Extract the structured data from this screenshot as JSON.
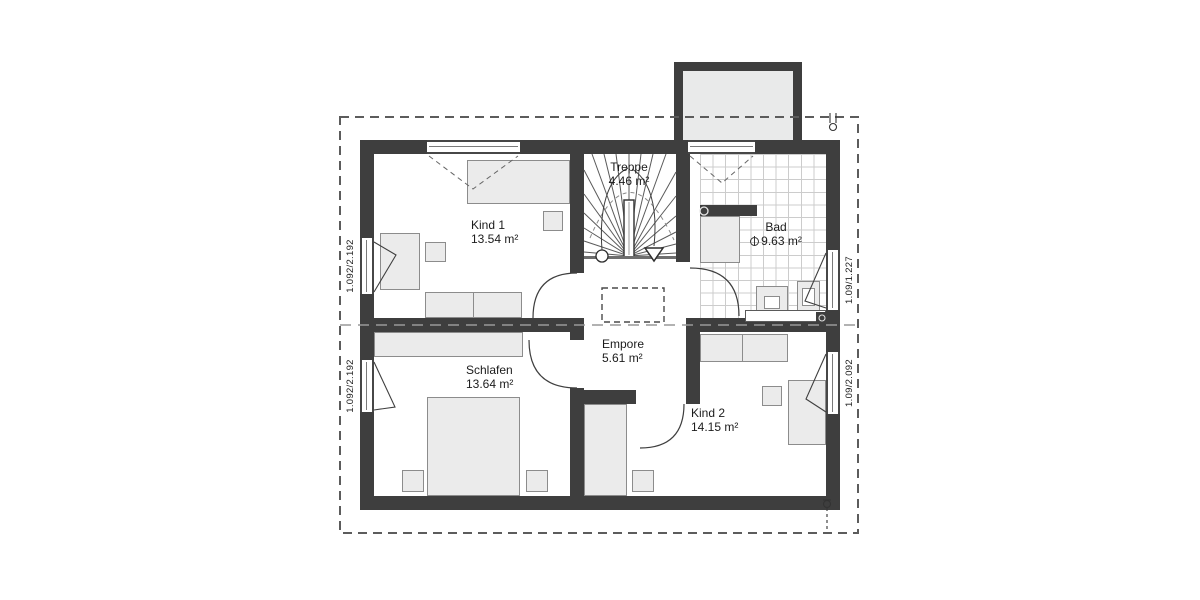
{
  "rooms": [
    {
      "id": "kind-1",
      "label": "Kind 1",
      "area": "13.54 m²"
    },
    {
      "id": "treppe",
      "label": "Treppe",
      "area": "4.46 m²"
    },
    {
      "id": "bad",
      "label": "Bad",
      "area": "9.63 m²"
    },
    {
      "id": "empore",
      "label": "Empore",
      "area": "5.61 m²"
    },
    {
      "id": "schlafen",
      "label": "Schlafen",
      "area": "13.64 m²"
    },
    {
      "id": "kind-2",
      "label": "Kind 2",
      "area": "14.15 m²"
    }
  ],
  "window_dimensions": {
    "left_top": "1.092/2.192",
    "left_bottom": "1.092/2.192",
    "right_top": "1.09/1.227",
    "right_bottom": "1.09/2.092"
  },
  "colors": {
    "wall": "#3e3e3e",
    "furniture_fill": "#ebebeb",
    "dormer_fill": "#e9eaea",
    "tile_line": "#cccccc",
    "line": "#3f3f3f",
    "background": "#ffffff"
  },
  "symbols": {
    "stair_direction_arrow": "triangle-down",
    "stair_start_marker": "circle",
    "bath_fixture_marker": "circle-with-line",
    "roof_drainpipe_marker": "circle"
  }
}
